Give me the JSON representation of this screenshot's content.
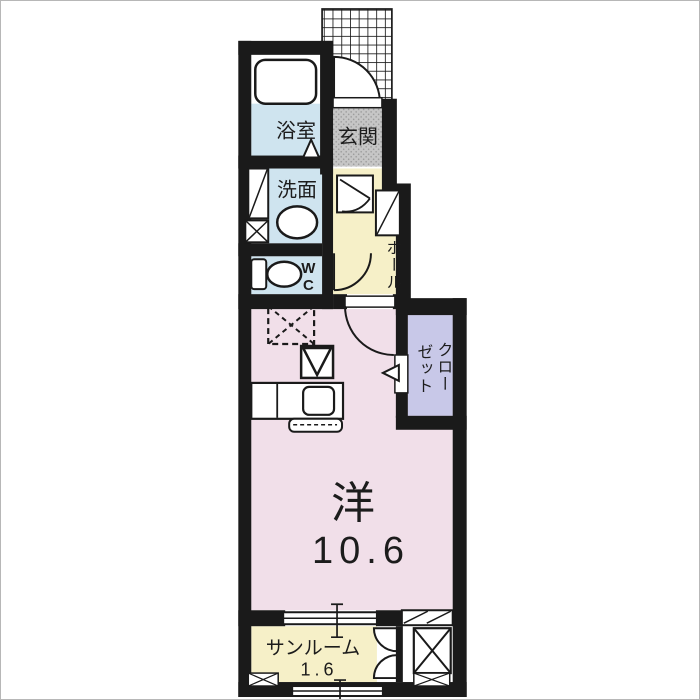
{
  "plan_title": "1K apartment floor plan",
  "colors": {
    "wall": "#1a1a1a",
    "bath_blue": "#cfe4ef",
    "entrance_gray": "#c6c6c6",
    "hall_yellow": "#f6f0c8",
    "room_pink": "#f1dfe9",
    "closet_lavender": "#c8c8e8",
    "sunroom_yellow": "#f6f0c8",
    "paper_white": "#ffffff"
  },
  "rooms": {
    "bath": {
      "label": "浴室"
    },
    "entrance": {
      "label": "玄関"
    },
    "washroom": {
      "label": "洗面"
    },
    "toilet": {
      "label": "WC"
    },
    "hall": {
      "label": "ホール"
    },
    "closet": {
      "label": "クローゼット",
      "line1": "クロー",
      "line2": "ゼット"
    },
    "living": {
      "label": "洋",
      "area": "10.6"
    },
    "sunroom": {
      "label": "サンルーム",
      "area": "1.6"
    }
  }
}
